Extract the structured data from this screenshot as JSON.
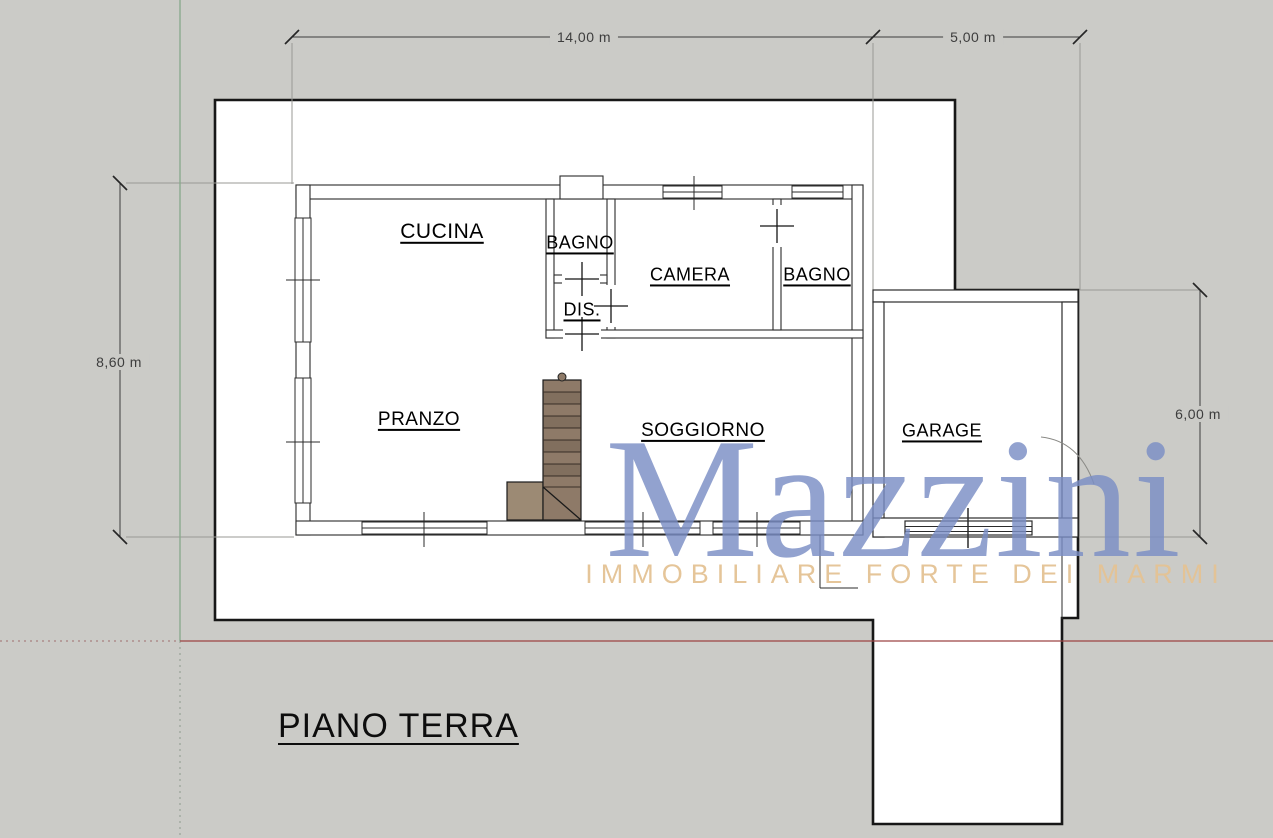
{
  "title": "PIANO TERRA",
  "watermark": {
    "brand": "Mazzini",
    "tagline": "IMMOBILIARE FORTE DEI MARMI",
    "brand_color": "#7a8ec4",
    "tagline_color": "#e4c294"
  },
  "room_labels": {
    "cucina": "CUCINA",
    "bagno_top": "BAGNO",
    "dis": "DIS.",
    "camera": "CAMERA",
    "bagno_right": "BAGNO",
    "pranzo": "PRANZO",
    "soggiorno": "SOGGIORNO",
    "garage": "GARAGE"
  },
  "dimensions": {
    "top_width": "14,00 m",
    "top_right_width": "5,00 m",
    "left_height": "8,60 m",
    "right_height": "6,00 m"
  },
  "colors": {
    "canvas": "#cbcbc7",
    "wall_line": "#2b2b2b",
    "axis_red": "#9c4343",
    "axis_green": "#87a98a",
    "stairs_wood": "#8e7a68",
    "stairs_landing": "#9c8a74"
  }
}
